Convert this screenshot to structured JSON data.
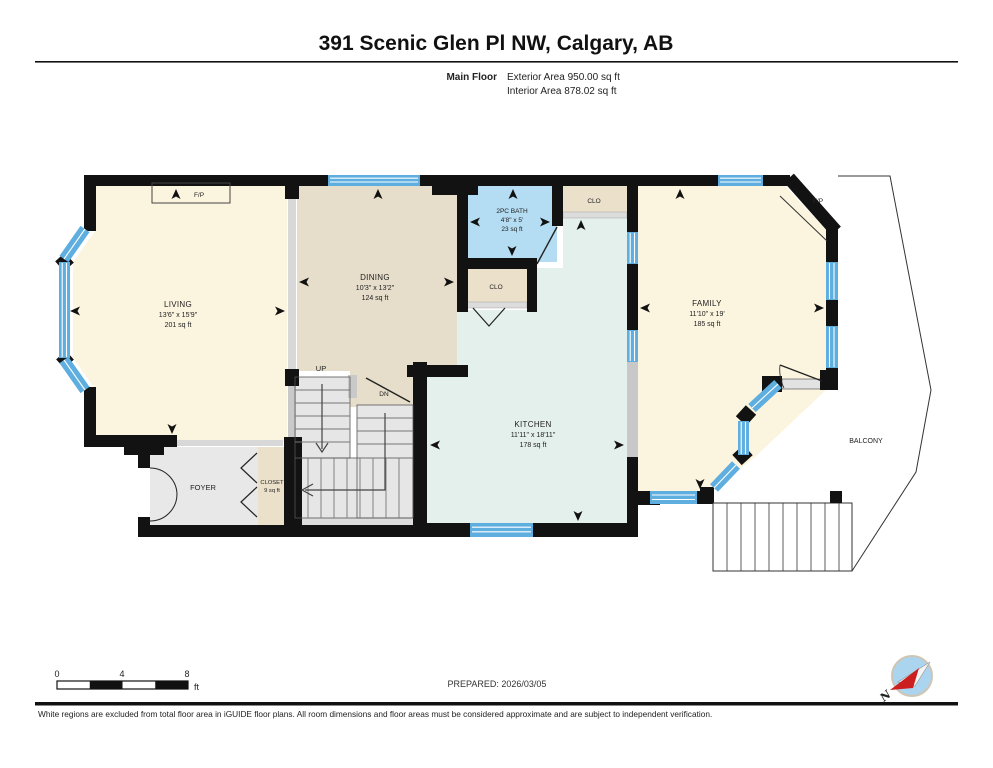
{
  "header": {
    "title": "391 Scenic Glen Pl NW, Calgary, AB",
    "floor_label": "Main Floor",
    "exterior_area": "Exterior Area 950.00 sq ft",
    "interior_area": "Interior Area 878.02 sq ft"
  },
  "rooms": {
    "living": {
      "name": "LIVING",
      "dims": "13'6\" x 15'9\"",
      "area": "201 sq ft"
    },
    "dining": {
      "name": "DINING",
      "dims": "10'3\" x 13'2\"",
      "area": "124 sq ft"
    },
    "bath": {
      "name": "2PC BATH",
      "dims": "4'8\" x 5'",
      "area": "23 sq ft"
    },
    "kitchen": {
      "name": "KITCHEN",
      "dims": "11'11\" x 18'11\"",
      "area": "178 sq ft"
    },
    "family": {
      "name": "FAMILY",
      "dims": "11'10\" x 19'",
      "area": "185 sq ft"
    },
    "foyer": {
      "name": "FOYER"
    },
    "closet": {
      "name": "CLOSET",
      "area": "9 sq ft"
    },
    "closet_top": {
      "name": "CLO"
    },
    "closet_mid": {
      "name": "CLO"
    },
    "balcony": {
      "name": "BALCONY"
    }
  },
  "annotations": {
    "fireplace_living": "F/P",
    "fireplace_family": "F/P",
    "stairs_up": "UP",
    "stairs_down": "DN",
    "compass_north": "N"
  },
  "scale_bar": {
    "tick_0": "0",
    "tick_4": "4",
    "tick_8": "8",
    "unit": "ft"
  },
  "prepared_label": "PREPARED: 2026/03/05",
  "footer": {
    "disclaimer": "White regions are excluded from total floor area in iGUIDE floor plans. All room dimensions and floor areas must be considered approximate and are subject to independent verification."
  },
  "colors": {
    "wall": "#121212",
    "window_blue": "#5FAEE0",
    "living_fill": "#FBF4DE",
    "dining_fill": "#E6DECB",
    "bath_fill": "#B4DCF2",
    "kitchen_fill": "#E4F0EB",
    "closet_fill": "#EBE0CA",
    "foyer_fill": "#E8E8E8"
  }
}
